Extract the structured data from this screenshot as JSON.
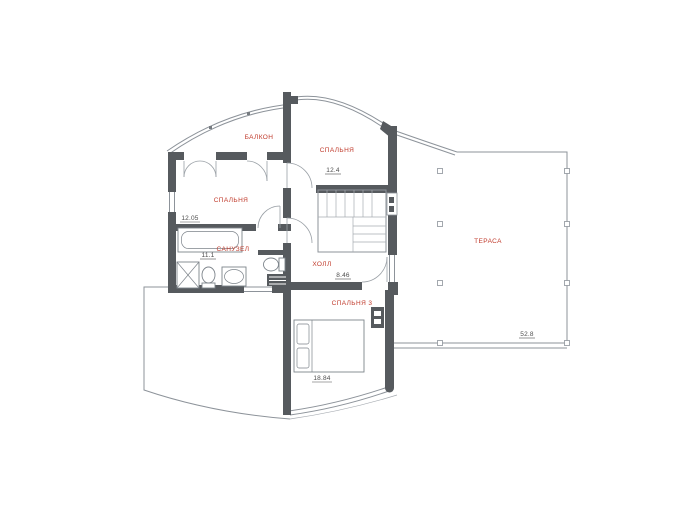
{
  "plan": {
    "type": "floor-plan",
    "rooms": [
      {
        "key": "balcony",
        "label": "БАЛКОН"
      },
      {
        "key": "bedroom-top",
        "label": "СПАЛЬНЯ",
        "area": "12.4"
      },
      {
        "key": "bedroom-left",
        "label": "СПАЛЬНЯ",
        "area": "12.05"
      },
      {
        "key": "bathroom",
        "label": "САНУЗЕЛ",
        "area": "11.1"
      },
      {
        "key": "hall",
        "label": "ХОЛЛ",
        "area": "8.46"
      },
      {
        "key": "bedroom-bottom",
        "label": "СПАЛЬНЯ 3",
        "area": "18.84"
      },
      {
        "key": "terrace",
        "label": "ТЕРАСА",
        "area": "52.8"
      }
    ],
    "colors": {
      "room_label": "#c03a2b",
      "area_value": "#4d4d4d",
      "wall": "#565a5e",
      "thin_line": "#8d939a",
      "background": "#ffffff"
    }
  }
}
